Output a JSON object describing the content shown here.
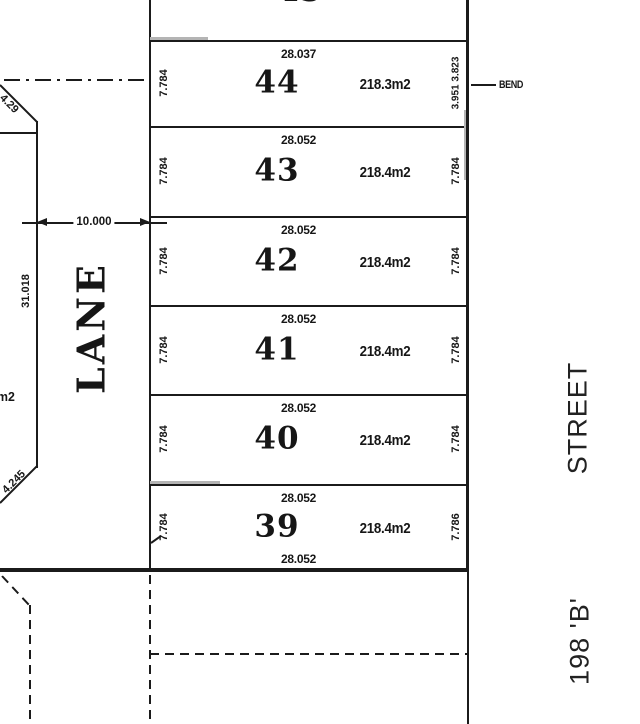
{
  "drawing": {
    "labels": {
      "lane": "LANE",
      "street": "STREET",
      "street_number": "198 'B'",
      "bend": "BEND"
    },
    "dimensions": {
      "lane_width": "10.000",
      "lane_side": "31.018",
      "chamfer_top": "4.29",
      "chamfer_bottom": "4.245",
      "left_area_partial": "m2"
    },
    "top_lot_partial": {
      "number": "45",
      "left_side": "9",
      "right_side": "9"
    },
    "lots": [
      {
        "number": "44",
        "top_dim": "28.037",
        "left_dim": "7.784",
        "right_dim": "3.951 3.823",
        "area": "218.3m2"
      },
      {
        "number": "43",
        "top_dim": "28.052",
        "left_dim": "7.784",
        "right_dim": "7.784",
        "area": "218.4m2"
      },
      {
        "number": "42",
        "top_dim": "28.052",
        "left_dim": "7.784",
        "right_dim": "7.784",
        "area": "218.4m2"
      },
      {
        "number": "41",
        "top_dim": "28.052",
        "left_dim": "7.784",
        "right_dim": "7.784",
        "area": "218.4m2"
      },
      {
        "number": "40",
        "top_dim": "28.052",
        "left_dim": "7.784",
        "right_dim": "7.784",
        "area": "218.4m2"
      },
      {
        "number": "39",
        "top_dim": "28.052",
        "bottom_dim": "28.052",
        "left_dim": "7.784",
        "right_dim": "7.786",
        "area": "218.4m2"
      }
    ],
    "colors": {
      "ink": "#1b1b1b",
      "paper": "#ffffff",
      "scan_gray": "#b4b4b4"
    }
  }
}
